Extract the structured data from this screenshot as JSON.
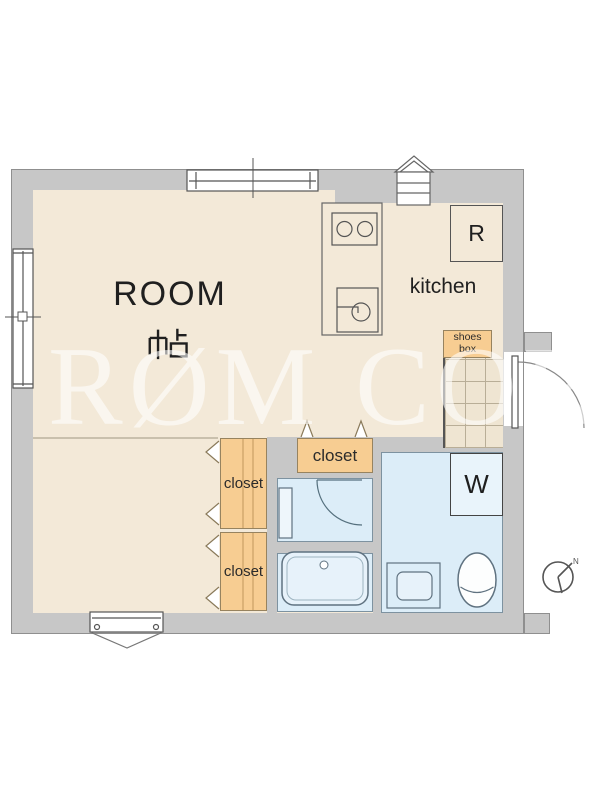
{
  "floorplan": {
    "room": {
      "label": "ROOM",
      "size_unit": "帖"
    },
    "kitchen": {
      "label": "kitchen",
      "refrigerator_label": "R",
      "fixtures": [
        "stove-2-burner",
        "sink"
      ]
    },
    "entrance": {
      "shoes_box_line1": "shoes",
      "shoes_box_line2": "box",
      "features": [
        "tiled-genkan",
        "entry-door-outswing"
      ]
    },
    "closets": {
      "hall": "closet",
      "upper": "closet",
      "lower": "closet"
    },
    "sanitary": {
      "washer_label": "W",
      "fixtures": [
        "vanity",
        "bathtub",
        "shower-pan",
        "toilet"
      ]
    },
    "compass": {
      "north_label": "N"
    },
    "watermark": {
      "text": "RØM CORE"
    },
    "colors": {
      "floor": "#f3e9d8",
      "wall": "#c7c7c7",
      "wall_outline": "#8f8f8f",
      "closet_orange": "#f7cd92",
      "wet_area_blue": "#dcedf8",
      "line": "#555555",
      "watermark_white": "#ffffff"
    }
  }
}
